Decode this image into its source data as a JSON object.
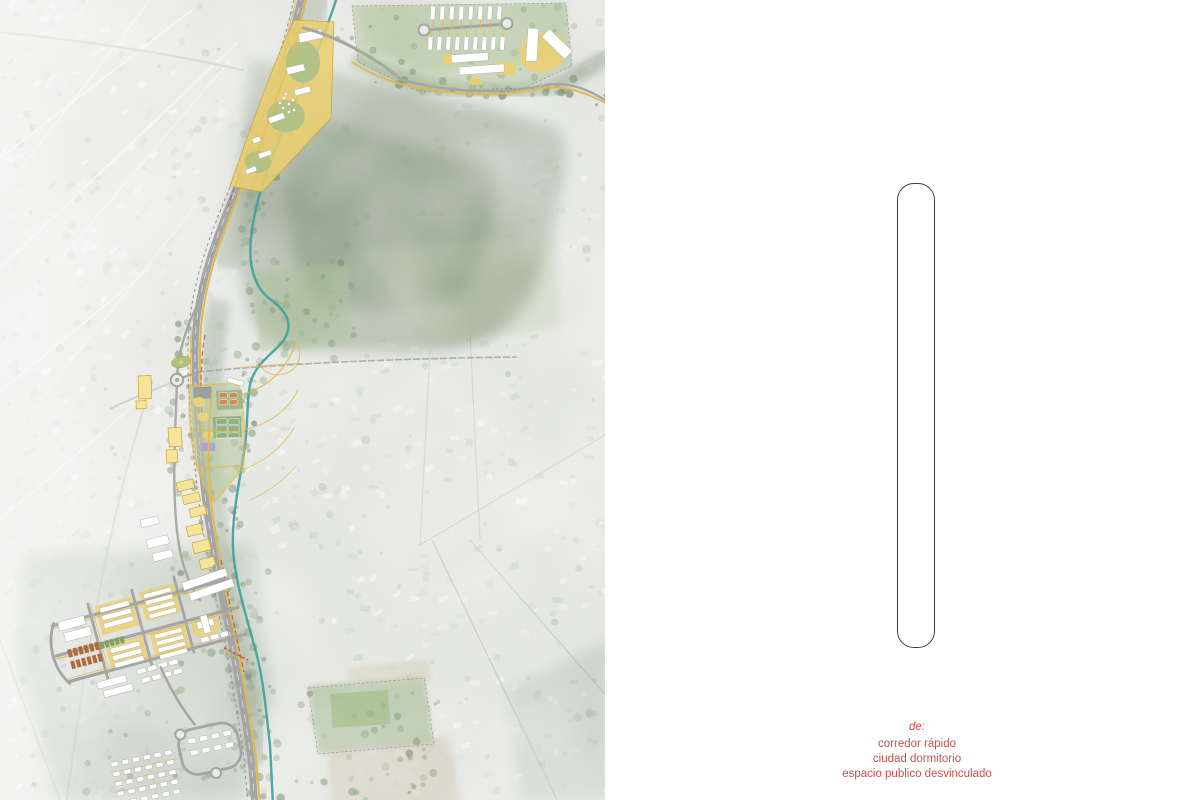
{
  "right_panel": {
    "caption": {
      "prefix": "de:",
      "lines": [
        "corredor rápido",
        "ciudad dormitorio",
        "espacio publico desvinculado"
      ]
    }
  },
  "map_panel": {
    "kind": "aerial-masterplan-map",
    "features": [
      "faded-aerial-city-fabric",
      "forest-hillside",
      "river-corridor",
      "main-road-corridor",
      "railway",
      "cycleway",
      "pedestrian-paths",
      "north-development-parcel",
      "hillside-housing-rows",
      "roundabout",
      "sports-park",
      "market-grid-development",
      "housing-loop",
      "sports-field"
    ]
  },
  "colors": {
    "accent_red": "#c9504b",
    "capsule_stroke": "#3f3f3f",
    "overlay_yellow": "#e2b84a",
    "parcel_yellow": "#ecd06e",
    "building_yellow": "#f6e49a",
    "road_gray": "#a5a5a5",
    "river_teal": "#3da0a0",
    "forest_green": "#75886b",
    "field_green": "#9cb780",
    "court_orange": "#cc8a55",
    "court_purple": "#b49fd6",
    "housing_brown": "#b06a3c",
    "bikeway_red": "#bf4f45",
    "map_base": "#e9ebe7",
    "page_bg": "#ffffff"
  }
}
